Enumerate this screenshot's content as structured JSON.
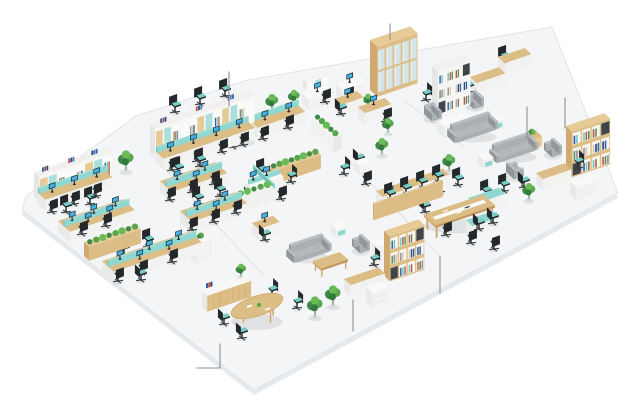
{
  "scene": {
    "background": "#ffffff",
    "canvas": {
      "w": 635,
      "h": 400
    },
    "palette": {
      "floor": "#f4f5f6",
      "floor_edge": "#e1e4e7",
      "floor_skirt": "#e7eaec",
      "seam": "#e7eaec",
      "wood": "#dcbd85",
      "wood_side": "#cfa970",
      "wood_dark": "#c2985e",
      "wood_light": "#e6cb96",
      "white": "#f9f9f8",
      "white_side": "#eaeae9",
      "white_front": "#f2f2f1",
      "teal": "#8fd8d2",
      "teal_dark": "#6fc2bb",
      "teal_light": "#aadfdb",
      "chair_black": "#24282b",
      "chair_dark": "#1b1e21",
      "chair_mid": "#33383c",
      "seat_teal": "#74cbc4",
      "sofa": "#aab0b2",
      "sofa_dark": "#8f9598",
      "sofa_light": "#b9bfc1",
      "sofa_top": "#b4b8ba",
      "green_1": "#3f8a46",
      "green_2": "#58a74f",
      "green_3": "#6abb58",
      "green_deep": "#347a3d",
      "binders": [
        "#2e5fa8",
        "#bf5240",
        "#27477e",
        "#4a7ec2"
      ],
      "bookset": [
        "#2e5fa8",
        "#6fc9c2",
        "#b65c42",
        "#5a8f5d",
        "#8a9096",
        "#d9c9a5",
        "#27477e"
      ],
      "glass": "#d6e4e8",
      "glass_hi": "#e7f1f4",
      "screen_blue": "#41b1e2",
      "monitor_dark": "#1f2428",
      "callout": "#8b9095",
      "shadow": "rgba(35,45,55,0.10)"
    },
    "floor": {
      "outline": [
        [
          22,
          210
        ],
        [
          26,
          196
        ],
        [
          136,
          116
        ],
        [
          248,
          80
        ],
        [
          552,
          27
        ],
        [
          618,
          193
        ],
        [
          254,
          390
        ]
      ],
      "skirt_offset": 5,
      "seams": [
        [
          [
            149,
            152
          ],
          [
            264,
            276
          ]
        ],
        [
          [
            346,
            157
          ],
          [
            441,
            257
          ]
        ],
        [
          [
            404,
            100
          ],
          [
            464,
            147
          ]
        ]
      ]
    },
    "callouts": [
      {
        "name": "callout-wall-shelving",
        "pts": [
          [
            229,
            72
          ],
          [
            229,
            106
          ]
        ]
      },
      {
        "name": "callout-tall-cabinet",
        "pts": [
          [
            390,
            24
          ],
          [
            390,
            39
          ]
        ]
      },
      {
        "name": "callout-lounge-table",
        "pts": [
          [
            527,
            107
          ],
          [
            527,
            139
          ]
        ]
      },
      {
        "name": "callout-bookcase",
        "pts": [
          [
            565,
            98
          ],
          [
            565,
            128
          ]
        ]
      },
      {
        "name": "callout-conference-zone",
        "pts": [
          [
            440,
            257
          ],
          [
            440,
            293
          ]
        ]
      },
      {
        "name": "callout-exec-desk",
        "pts": [
          [
            353,
            300
          ],
          [
            353,
            331
          ]
        ]
      },
      {
        "name": "callout-meeting-chairs",
        "pts": [
          [
            220,
            344
          ],
          [
            220,
            368
          ],
          [
            197,
            368
          ]
        ]
      }
    ],
    "type_names": {
      "chair": "office-chair",
      "deskrow": "workstation-row",
      "deskrow2": "workstation-cluster",
      "desk": "desk",
      "shelfwall": "wall-shelf-unit",
      "tallcabinet": "tall-cabinet",
      "bookshelf": "bookshelf",
      "hedge": "planter-hedge",
      "plant": "potted-plant",
      "sofa": "sofa",
      "armchair": "armchair",
      "sidetable": "side-table",
      "coffeetable": "coffee-table",
      "conftable": "conference-table",
      "ovaltable": "oval-meeting-table",
      "roundtable": "round-table",
      "counter": "reception-counter",
      "cabinet": "storage-cabinet",
      "books": "book-stack",
      "xpod": "cross-desk-pod",
      "hutchdesk": "hutch-desk",
      "benchpanel": "privacy-panel"
    },
    "items": [
      {
        "t": "chair",
        "x": 175,
        "y": 112,
        "f": "se"
      },
      {
        "t": "chair",
        "x": 200,
        "y": 104,
        "f": "se"
      },
      {
        "t": "chair",
        "x": 225,
        "y": 96,
        "f": "se"
      },
      {
        "t": "shelfwall",
        "x": 150,
        "y": 151,
        "L": 104,
        "H": 27,
        "n": "wall-shelf-north"
      },
      {
        "t": "deskrow",
        "x": 156,
        "y": 163,
        "L": 96,
        "m": 4
      },
      {
        "t": "chair",
        "x": 172,
        "y": 170,
        "f": "nw"
      },
      {
        "t": "chair",
        "x": 197,
        "y": 161,
        "f": "nw",
        "sy": 164
      },
      {
        "t": "chair",
        "x": 222,
        "y": 152,
        "f": "nw",
        "sy": 165
      },
      {
        "t": "chair",
        "x": 243,
        "y": 145,
        "f": "nw",
        "sy": 166
      },
      {
        "t": "shelfwall",
        "x": 34,
        "y": 196,
        "L": 76,
        "H": 24,
        "n": "wall-shelf-west"
      },
      {
        "t": "deskrow",
        "x": 38,
        "y": 204,
        "L": 70,
        "m": 3
      },
      {
        "t": "chair",
        "x": 52,
        "y": 212,
        "f": "nw"
      },
      {
        "t": "chair",
        "x": 74,
        "y": 204,
        "f": "nw",
        "sy": 206
      },
      {
        "t": "chair",
        "x": 96,
        "y": 196,
        "f": "nw",
        "sy": 207
      },
      {
        "t": "plant",
        "x": 126,
        "y": 172,
        "s": 6
      },
      {
        "t": "deskrow2",
        "x": 58,
        "y": 232,
        "L": 68,
        "m": 3
      },
      {
        "t": "chair",
        "x": 66,
        "y": 212,
        "f": "se"
      },
      {
        "t": "chair",
        "x": 90,
        "y": 204,
        "f": "se"
      },
      {
        "t": "chair",
        "x": 82,
        "y": 234,
        "f": "nw",
        "sy": 236
      },
      {
        "t": "chair",
        "x": 106,
        "y": 226,
        "f": "nw",
        "sy": 237
      },
      {
        "t": "hedge",
        "x": 84,
        "y": 256,
        "L": 54,
        "front": "wood"
      },
      {
        "t": "deskrow2",
        "x": 102,
        "y": 272,
        "L": 92,
        "m": 3
      },
      {
        "t": "chair",
        "x": 124,
        "y": 254,
        "f": "se"
      },
      {
        "t": "chair",
        "x": 148,
        "y": 246,
        "f": "se"
      },
      {
        "t": "chair",
        "x": 118,
        "y": 281,
        "f": "nw",
        "sy": 283
      },
      {
        "t": "chair",
        "x": 142,
        "y": 273,
        "f": "nw",
        "sy": 284
      },
      {
        "t": "chair",
        "x": 172,
        "y": 262,
        "f": "nw",
        "sy": 285
      },
      {
        "t": "cabinet",
        "x": 190,
        "y": 258,
        "L": 16,
        "D": 9,
        "H": 20,
        "plantTop": true
      },
      {
        "t": "chair",
        "x": 141,
        "y": 280,
        "f": "ne",
        "sy": 286
      },
      {
        "t": "deskrow2",
        "x": 160,
        "y": 192,
        "L": 58,
        "m": 2
      },
      {
        "t": "chair",
        "x": 178,
        "y": 174,
        "f": "se"
      },
      {
        "t": "chair",
        "x": 200,
        "y": 166,
        "f": "se"
      },
      {
        "t": "chair",
        "x": 170,
        "y": 200,
        "f": "nw"
      },
      {
        "t": "chair",
        "x": 192,
        "y": 192,
        "f": "nw",
        "sy": 194
      },
      {
        "t": "chair",
        "x": 214,
        "y": 184,
        "f": "nw",
        "sy": 195
      },
      {
        "t": "deskrow2",
        "x": 180,
        "y": 222,
        "L": 58,
        "m": 2
      },
      {
        "t": "chair",
        "x": 198,
        "y": 204,
        "f": "se"
      },
      {
        "t": "chair",
        "x": 220,
        "y": 196,
        "f": "se"
      },
      {
        "t": "chair",
        "x": 192,
        "y": 230,
        "f": "nw"
      },
      {
        "t": "chair",
        "x": 214,
        "y": 222,
        "f": "nw",
        "sy": 224
      },
      {
        "t": "chair",
        "x": 236,
        "y": 213,
        "f": "nw",
        "sy": 225
      },
      {
        "t": "hedge",
        "x": 228,
        "y": 210,
        "L": 42,
        "front": "white"
      },
      {
        "t": "xpod",
        "x": 264,
        "y": 190
      },
      {
        "t": "chair",
        "x": 250,
        "y": 202,
        "f": "ne"
      },
      {
        "t": "chair",
        "x": 281,
        "y": 199,
        "f": "nw"
      },
      {
        "t": "chair",
        "x": 262,
        "y": 176,
        "f": "se"
      },
      {
        "t": "chair",
        "x": 291,
        "y": 182,
        "f": "sw"
      },
      {
        "t": "desk",
        "x": 252,
        "y": 234,
        "L": 22,
        "top": "wood",
        "m": 1
      },
      {
        "t": "chair",
        "x": 265,
        "y": 240,
        "f": "ne"
      },
      {
        "t": "plant",
        "x": 272,
        "y": 112,
        "s": 5
      },
      {
        "t": "plant",
        "x": 294,
        "y": 106,
        "s": 4.5
      },
      {
        "t": "hutchdesk",
        "x": 302,
        "y": 104,
        "L": 26
      },
      {
        "t": "chair",
        "x": 325,
        "y": 102,
        "f": "nw",
        "sy": 106
      },
      {
        "t": "desk",
        "x": 334,
        "y": 110,
        "L": 24,
        "top": "wood",
        "m": 1
      },
      {
        "t": "chair",
        "x": 341,
        "y": 114,
        "f": "ne"
      },
      {
        "t": "deskrow",
        "x": 250,
        "y": 132,
        "L": 50,
        "m": 2
      },
      {
        "t": "chair",
        "x": 263,
        "y": 139,
        "f": "nw"
      },
      {
        "t": "chair",
        "x": 288,
        "y": 128,
        "f": "nw",
        "sy": 134
      },
      {
        "t": "roundtable",
        "x": 248,
        "y": 142,
        "r": 8
      },
      {
        "t": "chair",
        "x": 233,
        "y": 147,
        "f": "ne"
      },
      {
        "t": "desk",
        "x": 336,
        "y": 95,
        "L": 24,
        "top": "white",
        "m": 1
      },
      {
        "t": "chair",
        "x": 348,
        "y": 100,
        "f": "nw"
      },
      {
        "t": "desk",
        "x": 358,
        "y": 118,
        "L": 28,
        "top": "wood",
        "m": 1
      },
      {
        "t": "chair",
        "x": 386,
        "y": 121,
        "f": "nw"
      },
      {
        "t": "tallcabinet",
        "x": 370,
        "y": 90,
        "L": 42,
        "H": 50
      },
      {
        "t": "plant",
        "x": 368,
        "y": 108,
        "s": 4
      },
      {
        "t": "desk",
        "x": 498,
        "y": 68,
        "L": 28,
        "top": "wood"
      },
      {
        "t": "chair",
        "x": 504,
        "y": 63,
        "f": "se"
      },
      {
        "t": "desk",
        "x": 470,
        "y": 88,
        "L": 30,
        "top": "wood"
      },
      {
        "t": "chair",
        "x": 468,
        "y": 92,
        "f": "ne"
      },
      {
        "t": "bookshelf",
        "x": 432,
        "y": 110,
        "L": 34,
        "H": 44,
        "frame": "white"
      },
      {
        "t": "chair",
        "x": 426,
        "y": 100,
        "f": "sw",
        "sy": 112
      },
      {
        "t": "desk",
        "x": 438,
        "y": 132,
        "L": 26,
        "top": "white",
        "teal": true
      },
      {
        "t": "armchair",
        "x": 466,
        "y": 104,
        "o": "sw"
      },
      {
        "t": "armchair",
        "x": 424,
        "y": 116,
        "o": "se"
      },
      {
        "t": "sofa",
        "x": 450,
        "y": 138,
        "L": 40
      },
      {
        "t": "sidetable",
        "x": 488,
        "y": 126,
        "style": "teal"
      },
      {
        "t": "sidetable",
        "x": 524,
        "y": 144,
        "style": "wood",
        "plant": true
      },
      {
        "t": "sofa",
        "x": 492,
        "y": 158,
        "L": 38
      },
      {
        "t": "armchair",
        "x": 544,
        "y": 152,
        "o": "sw"
      },
      {
        "t": "armchair",
        "x": 506,
        "y": 174,
        "o": "ne"
      },
      {
        "t": "sidetable",
        "x": 478,
        "y": 164,
        "style": "teal"
      },
      {
        "t": "bookshelf",
        "x": 566,
        "y": 172,
        "L": 40,
        "H": 46,
        "frame": "wood"
      },
      {
        "t": "chair",
        "x": 578,
        "y": 168,
        "f": "sw",
        "sy": 175
      },
      {
        "t": "desk",
        "x": 536,
        "y": 184,
        "L": 30,
        "top": "wood"
      },
      {
        "t": "cabinet",
        "x": 570,
        "y": 195,
        "L": 22,
        "D": 9,
        "H": 14,
        "drawers": true
      },
      {
        "t": "chair",
        "x": 524,
        "y": 187,
        "f": "ne"
      },
      {
        "t": "plant",
        "x": 529,
        "y": 201,
        "s": 5
      },
      {
        "t": "desk",
        "x": 468,
        "y": 209,
        "L": 32,
        "top": "teal"
      },
      {
        "t": "chair",
        "x": 486,
        "y": 197,
        "f": "se"
      },
      {
        "t": "chair",
        "x": 504,
        "y": 191,
        "f": "se"
      },
      {
        "t": "desk",
        "x": 466,
        "y": 231,
        "L": 28,
        "top": "teal"
      },
      {
        "t": "chair",
        "x": 479,
        "y": 229,
        "f": "ne",
        "sy": 233
      },
      {
        "t": "chair",
        "x": 493,
        "y": 223,
        "f": "ne",
        "sy": 234
      },
      {
        "t": "hedge",
        "x": 311,
        "y": 132,
        "L": 30,
        "front": "white",
        "o": "v"
      },
      {
        "t": "hedge",
        "x": 268,
        "y": 180,
        "L": 50,
        "front": "wood"
      },
      {
        "t": "chair",
        "x": 359,
        "y": 164,
        "f": "ne"
      },
      {
        "t": "chair",
        "x": 344,
        "y": 174,
        "f": "sw"
      },
      {
        "t": "chair",
        "x": 366,
        "y": 184,
        "f": "nw"
      },
      {
        "t": "sidetable",
        "x": 354,
        "y": 170,
        "style": "white"
      },
      {
        "t": "plant",
        "x": 382,
        "y": 156,
        "s": 5
      },
      {
        "t": "plant",
        "x": 388,
        "y": 134,
        "s": 4.5
      },
      {
        "t": "desk",
        "x": 376,
        "y": 202,
        "L": 70,
        "top": "wood",
        "n": "bench-desk"
      },
      {
        "t": "books",
        "x": 388,
        "y": 192,
        "sy": 204
      },
      {
        "t": "benchpanel",
        "x": 373,
        "y": 219,
        "L": 72
      },
      {
        "t": "chair",
        "x": 390,
        "y": 200,
        "f": "se",
        "sy": 204
      },
      {
        "t": "chair",
        "x": 406,
        "y": 194,
        "f": "se",
        "sy": 205
      },
      {
        "t": "chair",
        "x": 422,
        "y": 188,
        "f": "se",
        "sy": 205
      },
      {
        "t": "chair",
        "x": 438,
        "y": 182,
        "f": "se",
        "sy": 206
      },
      {
        "t": "conftable",
        "x": 424,
        "y": 228,
        "L": 62,
        "D": 16
      },
      {
        "t": "chair",
        "x": 446,
        "y": 235,
        "f": "nw"
      },
      {
        "t": "chair",
        "x": 471,
        "y": 243,
        "f": "nw"
      },
      {
        "t": "chair",
        "x": 494,
        "y": 249,
        "f": "nw"
      },
      {
        "t": "chair",
        "x": 440,
        "y": 192,
        "f": "se"
      },
      {
        "t": "chair",
        "x": 458,
        "y": 185,
        "f": "se"
      },
      {
        "t": "chair",
        "x": 425,
        "y": 212,
        "f": "ne"
      },
      {
        "t": "plant",
        "x": 449,
        "y": 172,
        "s": 5
      },
      {
        "t": "sofa",
        "x": 289,
        "y": 258,
        "L": 34
      },
      {
        "t": "sidetable",
        "x": 331,
        "y": 233,
        "style": "teal"
      },
      {
        "t": "armchair",
        "x": 352,
        "y": 248,
        "o": "sw"
      },
      {
        "t": "coffeetable",
        "x": 313,
        "y": 270,
        "L": 28
      },
      {
        "t": "cabinet",
        "x": 372,
        "y": 262,
        "L": 11,
        "D": 7,
        "H": 20
      },
      {
        "t": "bookshelf",
        "x": 384,
        "y": 276,
        "L": 36,
        "H": 45,
        "frame": "wood"
      },
      {
        "t": "chair",
        "x": 374,
        "y": 265,
        "f": "sw",
        "sy": 278
      },
      {
        "t": "desk",
        "x": 344,
        "y": 290,
        "L": 36,
        "top": "wood"
      },
      {
        "t": "cabinet",
        "x": 366,
        "y": 302,
        "L": 17,
        "D": 9,
        "H": 15,
        "drawers": true
      },
      {
        "t": "counter",
        "x": 202,
        "y": 307,
        "L": 46
      },
      {
        "t": "books",
        "x": 207,
        "y": 288,
        "sy": 308
      },
      {
        "t": "plant",
        "x": 241,
        "y": 278,
        "s": 4
      },
      {
        "t": "ovaltable",
        "x": 257,
        "y": 318,
        "rx": 27
      },
      {
        "t": "chair",
        "x": 224,
        "y": 324,
        "f": "ne"
      },
      {
        "t": "chair",
        "x": 242,
        "y": 338,
        "f": "ne"
      },
      {
        "t": "chair",
        "x": 272,
        "y": 296,
        "f": "sw"
      },
      {
        "t": "chair",
        "x": 297,
        "y": 308,
        "f": "sw"
      },
      {
        "t": "plant",
        "x": 315,
        "y": 318,
        "s": 6
      },
      {
        "t": "plant",
        "x": 333,
        "y": 307,
        "s": 6
      }
    ]
  }
}
